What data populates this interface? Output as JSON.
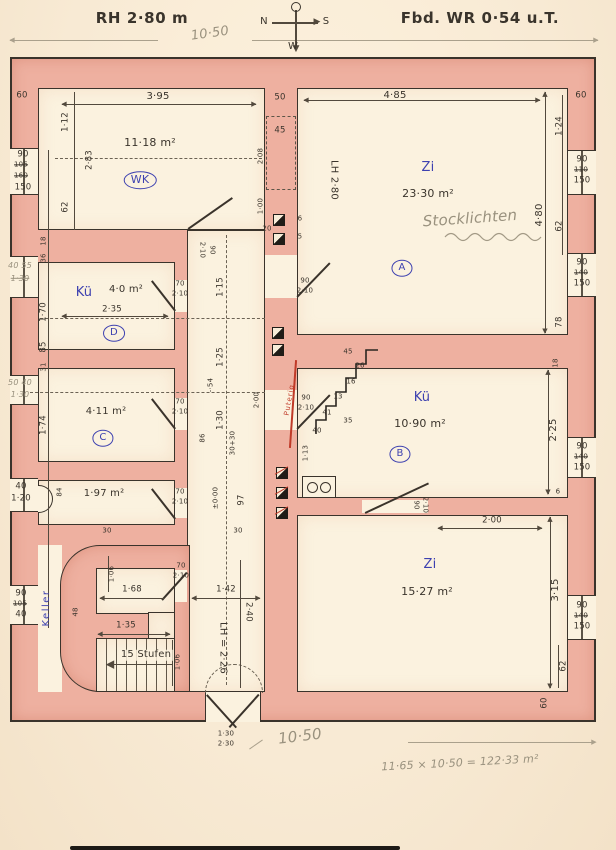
{
  "header": {
    "title_left": "RH 2·80 m",
    "title_right": "Fbd. WR 0·54 u.T.",
    "overall_width_pencil": "10·50",
    "compass": {
      "top": "O",
      "left": "N",
      "right": "S",
      "bottom": "W"
    }
  },
  "rooms": {
    "wk": {
      "name": "WK",
      "area": "11·18 m²"
    },
    "zi_a": {
      "name": "Zi",
      "area": "23·30 m²",
      "letter": "A",
      "clear_height": "LH 2·80",
      "pencil_note": "Stocklichten"
    },
    "kue_d": {
      "name": "Kü",
      "area": "4·0 m²",
      "letter": "D",
      "width": "2·35"
    },
    "c": {
      "area": "4·11 m²",
      "letter": "C"
    },
    "small": {
      "area": "1·97 m²"
    },
    "kue_b": {
      "name": "Kü",
      "area": "10·90 m²",
      "letter": "B",
      "pipe_note": "Puterig"
    },
    "zi_b": {
      "name": "Zi",
      "area": "15·27 m²"
    },
    "stair": {
      "steps": "15 Stufen",
      "cellar": "Keller",
      "clear_height": "LH = 2·26"
    }
  },
  "doors": {
    "d90": {
      "w": "90",
      "h": "2·10"
    },
    "d70": {
      "w": "70",
      "h": "2·10"
    },
    "entrance": {
      "w": "1·30",
      "h": "2·30"
    }
  },
  "windows": {
    "left1": {
      "w": "90",
      "old1": "105",
      "old2": "160",
      "cur": "150"
    },
    "left2_pencil": {
      "a": "40 55",
      "b": "1·30"
    },
    "left3_pencil": {
      "a": "50 40",
      "b": "1·30"
    },
    "left4": {
      "w": "40",
      "h": "1·20"
    },
    "left5": {
      "w": "90",
      "old": "105",
      "cur": "40"
    },
    "right1": {
      "w": "90",
      "old": "110",
      "cur": "150"
    },
    "right2": {
      "w": "90",
      "old": "140",
      "cur": "150"
    },
    "right3": {
      "w": "90",
      "old": "140",
      "cur": "150"
    },
    "right4": {
      "w": "90",
      "old": "140",
      "cur": "150"
    }
  },
  "dims": {
    "top_wall": "60",
    "wk_w": "3·95",
    "wk_112": "1·12",
    "wk_283": "2·83",
    "wk_62": "62",
    "mid_50": "50",
    "mid_45": "45",
    "mid_208": "2·08",
    "mid_100": "1·00",
    "mid_20": "20",
    "mid_6": "6",
    "mid_5": "5",
    "zi_w": "4·85",
    "zi_h": "4·80",
    "r_60": "60",
    "r_124": "1·24",
    "r_62": "62",
    "r_78": "78",
    "r_18": "18",
    "r_225": "2·25",
    "r_315": "3·15",
    "r_62b": "62",
    "r_60b": "60",
    "r_6": "6",
    "r_50p": "50",
    "l_18": "18",
    "l_36": "36",
    "l_170": "1·70",
    "l_85": "85",
    "l_31": "31",
    "l_174": "1·74",
    "l_84": "84",
    "c_115": "1·15",
    "c_125": "1·25",
    "c_54": "-·54",
    "c_130": "1·30",
    "c_86": "86",
    "c_3030": "30+30",
    "c_97": "97",
    "c_000": "±0·00",
    "c_200": "2·00",
    "c_142": "1·42",
    "c_240": "2·40",
    "c_30a": "30",
    "c_30b": "30",
    "s_106a": "1·06",
    "s_168": "1·68",
    "s_48": "48",
    "s_135": "1·35",
    "s_106b": "1·06",
    "k_113": "1·13",
    "zb_200": "2·00",
    "zig": [
      "45",
      "26",
      "16",
      "13",
      "41",
      "35",
      "40"
    ]
  },
  "footer": {
    "overall_width_pencil": "10·50",
    "calc": "11·65 × 10·50 = 122·33 m²"
  }
}
